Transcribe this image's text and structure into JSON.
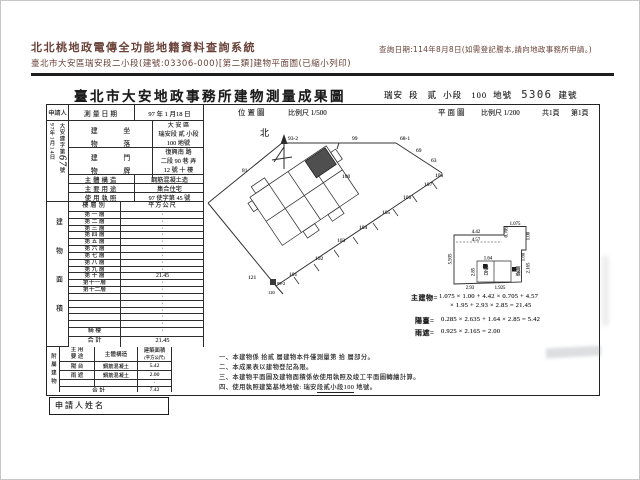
{
  "system_header": {
    "app_title": "北北桃地政電傳全功能地籍資料查詢系統",
    "query_date_note": "查詢日期:114年8月8日(如需登記謄本,請向地政事務所申請。)",
    "doc_line": "臺北市大安區瑞安段二小段(建號:03306-000)[第二類]建物平面圖(已縮小列印)"
  },
  "doc": {
    "title": "臺北市大安地政事務所建物測量成果圖",
    "ref": {
      "section": "瑞安",
      "sec_label": "段",
      "sub": "貳",
      "sub_label": "小段",
      "land_no": "100",
      "land_label": "地號",
      "bldg_no": "5306",
      "bldg_label": "建號"
    },
    "scale_row": {
      "loc_label": "位置圖",
      "loc_scale": "比例尺 1/500",
      "plan_label": "平面圖",
      "plan_scale": "比例尺 1/200",
      "pages_total": "共1頁",
      "page_no": "第1頁"
    },
    "applicant": {
      "label": "申請人",
      "recv_date": "97年1月14日",
      "doc_prefix": "大安建字第",
      "doc_no": "67",
      "doc_suffix": "號"
    },
    "fields": {
      "survey_date_label": "測量日期",
      "survey_date": "97 年 1 月18 日",
      "site_l1": "建",
      "site_l2": "坐",
      "site_l3": "物",
      "site_l4": "落",
      "site_line1": "大 安 區",
      "site_line2": "瑞安段 貳 小段",
      "site_line3": "100  地號",
      "addr_l1": "建",
      "addr_l2": "門",
      "addr_l3": "物",
      "addr_l4": "牌",
      "addr_line1": "復興南  路",
      "addr_line2": "二段 90 巷    弄",
      "addr_line3": "12 號 十 樓",
      "structure_label": "主體構造",
      "structure": "鋼筋混凝土造",
      "usage_label": "主要用途",
      "usage": "集合住宅",
      "license_label": "使用執照",
      "license": "97 使字第 45  號"
    },
    "floor_area": {
      "side_label": "建物面積",
      "col1": "樓層別",
      "col2": "平方公尺",
      "rows": [
        [
          "第 一 層",
          "·"
        ],
        [
          "第 二 層",
          "·"
        ],
        [
          "第 三 層",
          "·"
        ],
        [
          "第 四 層",
          "·"
        ],
        [
          "第 五 層",
          "·"
        ],
        [
          "第 六 層",
          "·"
        ],
        [
          "第 七 層",
          "·"
        ],
        [
          "第 八 層",
          "·"
        ],
        [
          "第 九 層",
          "·"
        ],
        [
          "第 十 層",
          "21.45"
        ],
        [
          "第十一層",
          "·"
        ],
        [
          "第十二層",
          "·"
        ],
        [
          "",
          "·"
        ],
        [
          "",
          "·"
        ],
        [
          "",
          "·"
        ],
        [
          "",
          "·"
        ],
        [
          "",
          "·"
        ]
      ],
      "arcade_label": "騎  樓",
      "arcade_value": "·",
      "total_label": "合  計",
      "total_value": "21.45"
    },
    "annex": {
      "side_label": "附屬建物",
      "h_usage_1": "主 用",
      "h_usage_2": "要 途",
      "h_structure": "主體構造",
      "h_area_1": "建築面積",
      "h_area_2": "(平方公尺)",
      "rows": [
        [
          "陽 台",
          "鋼筋混凝土",
          "5.42"
        ],
        [
          "雨 遮",
          "鋼筋混凝土",
          "2.00"
        ],
        [
          "",
          "",
          "·"
        ]
      ],
      "total_label": "合  計",
      "total_value": "7.42"
    },
    "applicant_name_label": "申請人姓名",
    "map": {
      "north": "北",
      "parcels": [
        "93-2",
        "99",
        "68-1",
        "69",
        "63",
        "108",
        "107",
        "106",
        "105",
        "104",
        "103",
        "102",
        "101",
        "81",
        "100",
        "121",
        "120",
        "99-2"
      ]
    },
    "plan": {
      "dims": [
        "4.42",
        "0.705",
        "1.075",
        "1.00",
        "4.57",
        "5.935",
        "1.64",
        "2.85",
        "1.60",
        "2.165",
        "2.93",
        "1.925"
      ],
      "balcony": "陽台",
      "canopy": "雨遮"
    },
    "formulas": {
      "main_label": "主建物=",
      "main_l1": "1.075 × 1.00 + 4.42 × 0.705 + 4.57",
      "main_l2": "× 1.95 + 2.93 × 2.85 = 21.45",
      "balcony_label": "陽臺=",
      "balcony": "0.285 × 2.635 + 1.64 × 2.85 = 5.42",
      "canopy_label": "雨遮=",
      "canopy": "0.925 × 2.165 = 2.00"
    },
    "notes": [
      "一、本建物係 拾貳 層建物本件僅測量第 拾 層部分。",
      "二、本成果表以建物登記為限。",
      "三、本建物平面圖及建物面積係依使用執照及竣工平面圖轉繪計算。"
    ],
    "note4": {
      "prefix": "四、使用執照建築基地地號: 瑞安",
      "u": "段貳小段100",
      "suffix": " 地號。"
    }
  }
}
